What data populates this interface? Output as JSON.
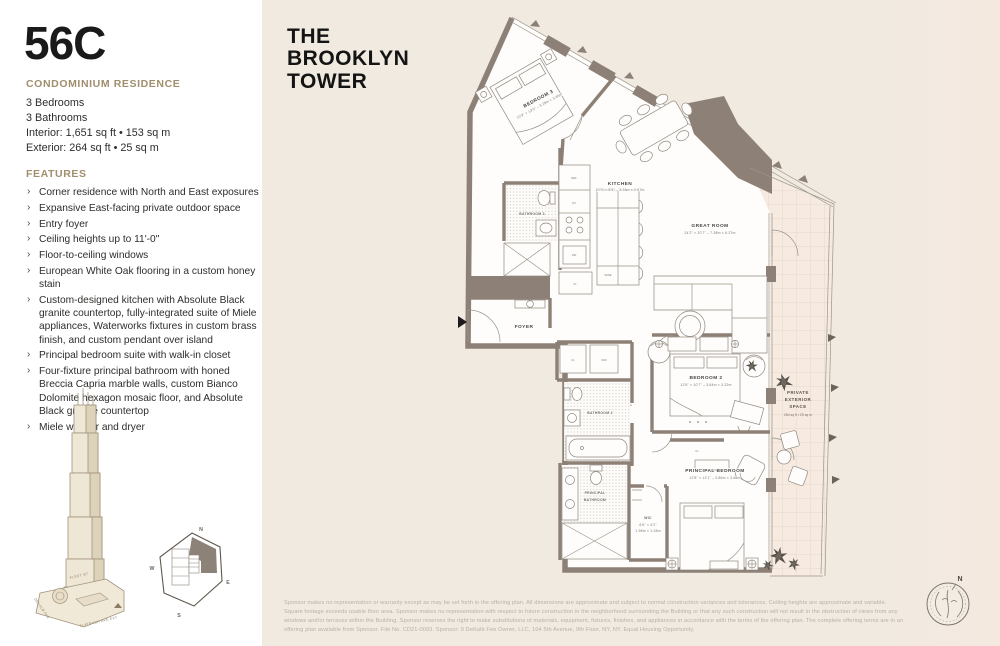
{
  "unit": {
    "number": "56C",
    "residence_type": "CONDOMINIUM RESIDENCE",
    "specs": [
      "3 Bedrooms",
      "3 Bathrooms",
      "Interior: 1,651 sq ft • 153 sq m",
      "Exterior: 264 sq ft • 25 sq m"
    ]
  },
  "features": {
    "title": "FEATURES",
    "items": [
      "Corner residence with North and East exposures",
      "Expansive East-facing private outdoor space",
      "Entry foyer",
      "Ceiling heights up to 11'-0\"",
      "Floor-to-ceiling windows",
      "European White Oak flooring in a custom honey stain",
      "Custom-designed kitchen with Absolute Black granite countertop, fully-integrated suite of Miele appliances, Waterworks fixtures in custom brass finish, and custom pendant over island",
      "Principal bedroom suite with walk-in closet",
      "Four-fixture principal bathroom with honed Breccia Capria marble walls, custom Bianco Dolomite hexagon mosaic floor, and Absolute Black granite countertop",
      "Miele washer and dryer"
    ]
  },
  "brand": {
    "line1": "THE",
    "line2": "BROOKLYN",
    "line3": "TOWER"
  },
  "floorplan": {
    "bedroom3": {
      "name": "BEDROOM 3",
      "dims": "10'9\" × 13'0\" – 3.28m × 3.96m"
    },
    "kitchen": {
      "name": "KITCHEN",
      "dims": "10'9\" × 8'5\" – 3.28m × 2.57m"
    },
    "great_room": {
      "name": "GREAT ROOM",
      "dims": "24'2\" × 20'7\" – 7.38m × 6.27m"
    },
    "bedroom2": {
      "name": "BEDROOM 2",
      "dims": "12'6\" × 10'7\" – 3.84m × 3.22m"
    },
    "principal_bedroom": {
      "name": "PRINCIPAL BEDROOM",
      "dims": "12'8\" × 12'1\" – 3.86m × 3.68m"
    },
    "principal_bathroom": {
      "line1": "PRINCIPAL",
      "line2": "BATHROOM"
    },
    "bathroom2": {
      "name": "BATHROOM 2"
    },
    "bathroom3": {
      "name": "BATHROOM 3"
    },
    "wic": {
      "name": "WIC",
      "dims1": "6'6\" × 4'2\"",
      "dims2": "1.98m × 1.28m"
    },
    "foyer": {
      "name": "FOYER"
    },
    "exterior": {
      "line1": "PRIVATE",
      "line2": "EXTERIOR",
      "line3": "SPACE",
      "area": "264 sq ft • 25 sq m"
    },
    "small_labels": {
      "cl": "CL",
      "wd": "W/D",
      "ref": "REF",
      "dw": "DW",
      "ov": "OV",
      "wine": "WINE"
    }
  },
  "keyplan": {
    "north": "N",
    "south": "S",
    "east": "E",
    "west": "W",
    "streets": {
      "fleet": "FLEET ST",
      "dekalb": "DEKALB AVE",
      "flatbush": "FLATBUSH AVE EXT"
    }
  },
  "compass": {
    "north": "N"
  },
  "disclaimer": "Sponsor makes no representation or warranty except as may be set forth in the offering plan. All dimensions are approximate and subject to normal construction variances and tolerances. Ceiling heights are approximate and variable. Square footage exceeds usable floor area. Sponsor makes no representation with respect to future construction in the neighborhood surrounding the Building or that any such construction will not result in the obstruction of views from any windows and/or terraces within the Building. Sponsor reserves the right to make substitutions of materials, equipment, fixtures, finishes, and appliances in accordance with the terms of the offering plan. The complete offering terms are in an offering plan available from Sponsor. File No. CD21-0093. Sponsor: 9 DeKalb Fee Owner, LLC, 104 5th Avenue, 9th Floor, NY, NY. Equal Housing Opportunity."
}
